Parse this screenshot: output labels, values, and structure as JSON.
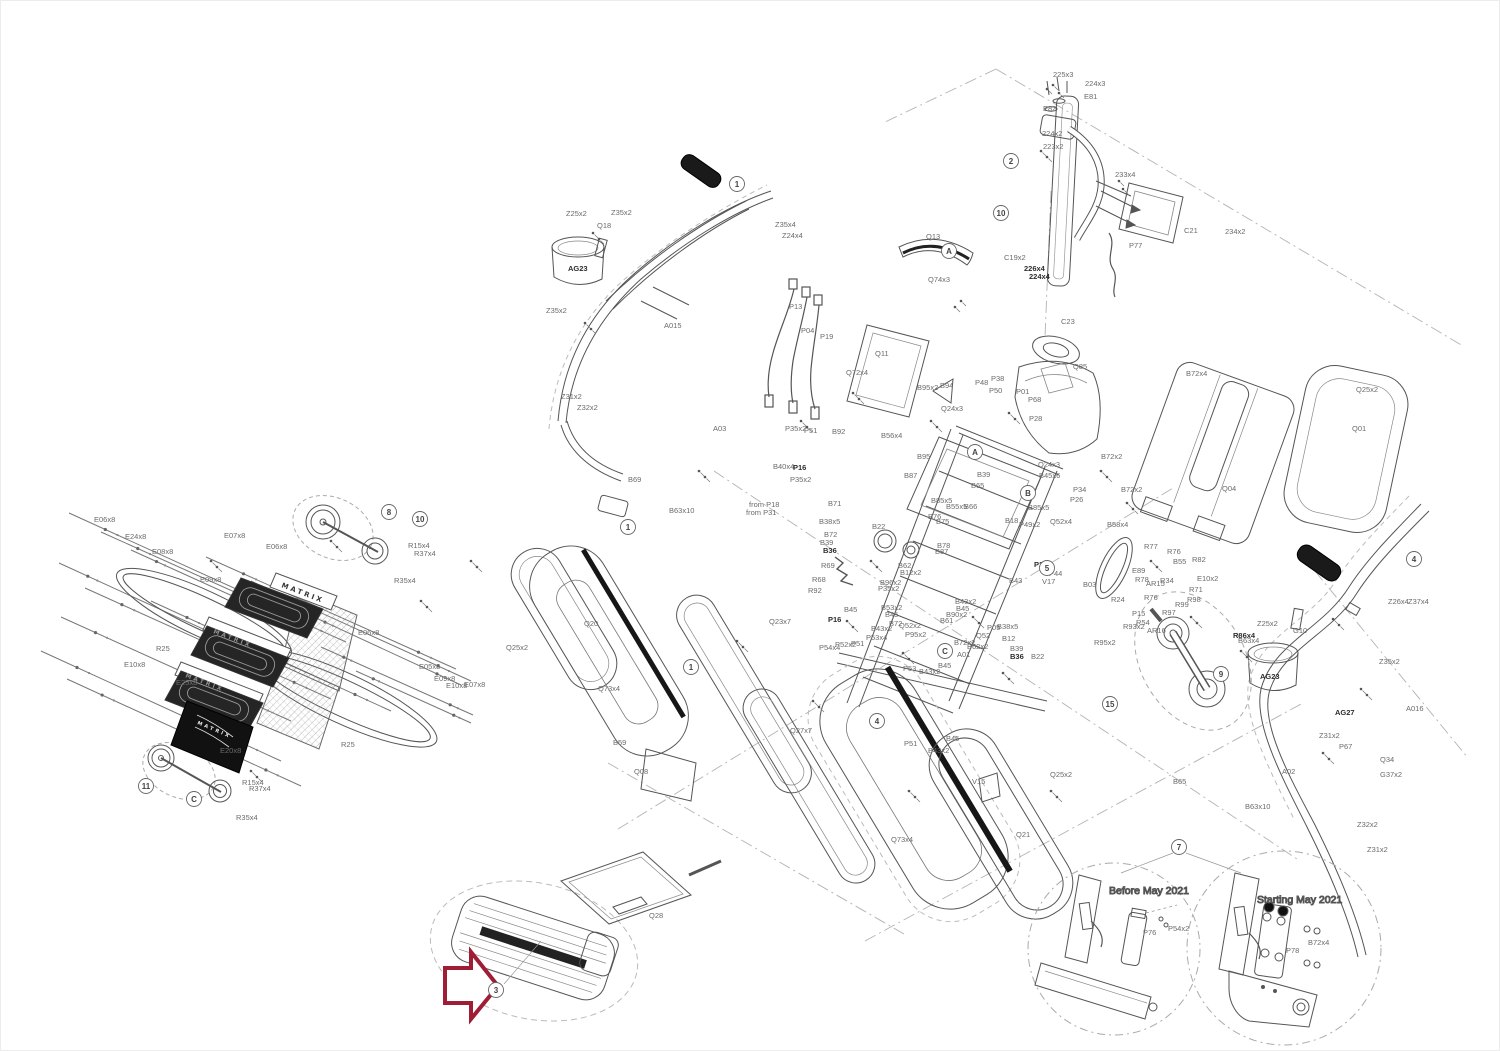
{
  "meta": {
    "brand": "MATRIX",
    "diagram_type": "exploded parts diagram"
  },
  "colors": {
    "line": "#555555",
    "label": "#6b6b6b",
    "arrow": "#a01e35",
    "dash": "#b3b3b3",
    "dark_part": "#1c1c1c"
  },
  "detail_views": [
    {
      "title": "Before May 2021",
      "parts": [
        "P76",
        "P54x2"
      ]
    },
    {
      "title": "Starting May 2021",
      "parts": [
        "P78",
        "B72x4"
      ]
    }
  ],
  "arrow": {
    "balloon": "3"
  },
  "balloons": [
    {
      "n": "1",
      "x": 736,
      "y": 183
    },
    {
      "n": "2",
      "x": 1010,
      "y": 160
    },
    {
      "n": "10",
      "x": 1000,
      "y": 212
    },
    {
      "n": "A",
      "x": 948,
      "y": 250
    },
    {
      "n": "A",
      "x": 974,
      "y": 451
    },
    {
      "n": "B",
      "x": 1027,
      "y": 492
    },
    {
      "n": "5",
      "x": 1046,
      "y": 567
    },
    {
      "n": "C",
      "x": 944,
      "y": 650
    },
    {
      "n": "1",
      "x": 690,
      "y": 666
    },
    {
      "n": "1",
      "x": 627,
      "y": 526
    },
    {
      "n": "4",
      "x": 876,
      "y": 720
    },
    {
      "n": "4",
      "x": 1413,
      "y": 558
    },
    {
      "n": "9",
      "x": 1220,
      "y": 673
    },
    {
      "n": "15",
      "x": 1109,
      "y": 703
    },
    {
      "n": "8",
      "x": 388,
      "y": 511
    },
    {
      "n": "10",
      "x": 419,
      "y": 518
    },
    {
      "n": "11",
      "x": 145,
      "y": 785
    },
    {
      "n": "C",
      "x": 193,
      "y": 798
    },
    {
      "n": "7",
      "x": 1178,
      "y": 846
    },
    {
      "n": "3",
      "x": 495,
      "y": 989
    }
  ],
  "brand_marks": [
    {
      "text": "MATRIX",
      "x": 280,
      "y": 586,
      "rot": 21,
      "fill": "#3a3a3a",
      "size": 7
    },
    {
      "text": "MATRIX",
      "x": 212,
      "y": 632,
      "rot": 21,
      "fill": "#8f8f8f",
      "size": 6
    },
    {
      "text": "MATRIX",
      "x": 184,
      "y": 676,
      "rot": 21,
      "fill": "#8f8f8f",
      "size": 6
    },
    {
      "text": "MATRIX",
      "x": 196,
      "y": 723,
      "rot": 23,
      "fill": "#e8e8e8",
      "size": 5
    }
  ],
  "labels": [
    {
      "t": "225x3",
      "x": 1052,
      "y": 76
    },
    {
      "t": "224x3",
      "x": 1084,
      "y": 85
    },
    {
      "t": "E81",
      "x": 1083,
      "y": 98
    },
    {
      "t": "E82",
      "x": 1042,
      "y": 110
    },
    {
      "t": "224x2",
      "x": 1041,
      "y": 135
    },
    {
      "t": "223x2",
      "x": 1042,
      "y": 148
    },
    {
      "t": "233x4",
      "x": 1114,
      "y": 176
    },
    {
      "t": "C21",
      "x": 1183,
      "y": 232
    },
    {
      "t": "234x2",
      "x": 1224,
      "y": 233
    },
    {
      "t": "P77",
      "x": 1128,
      "y": 247
    },
    {
      "t": "C19x2",
      "x": 1003,
      "y": 259
    },
    {
      "t": "226x4",
      "x": 1023,
      "y": 270,
      "b": 1
    },
    {
      "t": "224x4",
      "x": 1028,
      "y": 278,
      "b": 1
    },
    {
      "t": "Q13",
      "x": 925,
      "y": 238
    },
    {
      "t": "Q74x3",
      "x": 927,
      "y": 281
    },
    {
      "t": "C23",
      "x": 1060,
      "y": 323
    },
    {
      "t": "Q85",
      "x": 1072,
      "y": 368
    },
    {
      "t": "P13",
      "x": 788,
      "y": 308
    },
    {
      "t": "P04",
      "x": 800,
      "y": 332
    },
    {
      "t": "P19",
      "x": 819,
      "y": 338
    },
    {
      "t": "Q11",
      "x": 874,
      "y": 355
    },
    {
      "t": "Q72x4",
      "x": 845,
      "y": 374
    },
    {
      "t": "B95x2",
      "x": 916,
      "y": 389
    },
    {
      "t": "B94",
      "x": 939,
      "y": 387
    },
    {
      "t": "Q24x3",
      "x": 940,
      "y": 410
    },
    {
      "t": "P48",
      "x": 974,
      "y": 384
    },
    {
      "t": "P38",
      "x": 990,
      "y": 380
    },
    {
      "t": "P50",
      "x": 988,
      "y": 392
    },
    {
      "t": "P01",
      "x": 1015,
      "y": 393
    },
    {
      "t": "P68",
      "x": 1027,
      "y": 401
    },
    {
      "t": "P28",
      "x": 1028,
      "y": 420
    },
    {
      "t": "B72x2",
      "x": 1100,
      "y": 458
    },
    {
      "t": "B72x2",
      "x": 1120,
      "y": 491
    },
    {
      "t": "P34",
      "x": 1072,
      "y": 491
    },
    {
      "t": "P26",
      "x": 1069,
      "y": 501
    },
    {
      "t": "B58x4",
      "x": 1106,
      "y": 526
    },
    {
      "t": "Q52x4",
      "x": 1049,
      "y": 523
    },
    {
      "t": "B45x6",
      "x": 1038,
      "y": 477
    },
    {
      "t": "Q24x3",
      "x": 1037,
      "y": 466
    },
    {
      "t": "P49x2",
      "x": 1018,
      "y": 526
    },
    {
      "t": "B18",
      "x": 1004,
      "y": 522
    },
    {
      "t": "B85x5",
      "x": 1027,
      "y": 509
    },
    {
      "t": "B55x5",
      "x": 945,
      "y": 508
    },
    {
      "t": "B66",
      "x": 963,
      "y": 508
    },
    {
      "t": "B85x5",
      "x": 930,
      "y": 502
    },
    {
      "t": "B76",
      "x": 927,
      "y": 518
    },
    {
      "t": "B75",
      "x": 935,
      "y": 523
    },
    {
      "t": "B78",
      "x": 936,
      "y": 547
    },
    {
      "t": "B87",
      "x": 934,
      "y": 553
    },
    {
      "t": "B39",
      "x": 976,
      "y": 476
    },
    {
      "t": "B65",
      "x": 970,
      "y": 487
    },
    {
      "t": "B56x4",
      "x": 880,
      "y": 437
    },
    {
      "t": "B95",
      "x": 916,
      "y": 458
    },
    {
      "t": "B87",
      "x": 903,
      "y": 477
    },
    {
      "t": "B71",
      "x": 827,
      "y": 505
    },
    {
      "t": "B38x5",
      "x": 818,
      "y": 523
    },
    {
      "t": "B72",
      "x": 823,
      "y": 536
    },
    {
      "t": "B39",
      "x": 819,
      "y": 544
    },
    {
      "t": "B36",
      "x": 822,
      "y": 552,
      "b": 1
    },
    {
      "t": "R69",
      "x": 820,
      "y": 567
    },
    {
      "t": "R68",
      "x": 811,
      "y": 581
    },
    {
      "t": "R92",
      "x": 807,
      "y": 592
    },
    {
      "t": "B22",
      "x": 871,
      "y": 528
    },
    {
      "t": "P51",
      "x": 803,
      "y": 432
    },
    {
      "t": "B92",
      "x": 831,
      "y": 433
    },
    {
      "t": "P35x2",
      "x": 784,
      "y": 430
    },
    {
      "t": "B40x4",
      "x": 772,
      "y": 468
    },
    {
      "t": "P16",
      "x": 792,
      "y": 469,
      "b": 1
    },
    {
      "t": "P35x2",
      "x": 789,
      "y": 481
    },
    {
      "t": "B62",
      "x": 897,
      "y": 567
    },
    {
      "t": "B12x2",
      "x": 899,
      "y": 574
    },
    {
      "t": "B96x2",
      "x": 879,
      "y": 584
    },
    {
      "t": "P35x2",
      "x": 877,
      "y": 590
    },
    {
      "t": "B45",
      "x": 843,
      "y": 611
    },
    {
      "t": "P16",
      "x": 827,
      "y": 621,
      "b": 1
    },
    {
      "t": "B53x2",
      "x": 880,
      "y": 609
    },
    {
      "t": "B45",
      "x": 884,
      "y": 616
    },
    {
      "t": "B43x2",
      "x": 870,
      "y": 630
    },
    {
      "t": "B72",
      "x": 888,
      "y": 625
    },
    {
      "t": "Q52x2",
      "x": 898,
      "y": 627
    },
    {
      "t": "P95x2",
      "x": 904,
      "y": 636
    },
    {
      "t": "P53x4",
      "x": 865,
      "y": 639
    },
    {
      "t": "P52x2",
      "x": 834,
      "y": 646
    },
    {
      "t": "P51",
      "x": 850,
      "y": 645
    },
    {
      "t": "P54x4",
      "x": 818,
      "y": 649
    },
    {
      "t": "B90x2",
      "x": 945,
      "y": 616
    },
    {
      "t": "B61",
      "x": 939,
      "y": 622
    },
    {
      "t": "B43x2",
      "x": 954,
      "y": 603
    },
    {
      "t": "B45",
      "x": 955,
      "y": 610
    },
    {
      "t": "P05",
      "x": 986,
      "y": 629
    },
    {
      "t": "B38x5",
      "x": 996,
      "y": 628
    },
    {
      "t": "B12",
      "x": 1001,
      "y": 640
    },
    {
      "t": "B39",
      "x": 1009,
      "y": 650
    },
    {
      "t": "B36",
      "x": 1009,
      "y": 658,
      "b": 1
    },
    {
      "t": "B22",
      "x": 1030,
      "y": 658
    },
    {
      "t": "B72x2",
      "x": 953,
      "y": 644
    },
    {
      "t": "Q52",
      "x": 975,
      "y": 637
    },
    {
      "t": "B62x2",
      "x": 966,
      "y": 648
    },
    {
      "t": "A01",
      "x": 956,
      "y": 656
    },
    {
      "t": "P53",
      "x": 902,
      "y": 670
    },
    {
      "t": "B43x2",
      "x": 918,
      "y": 673
    },
    {
      "t": "B45",
      "x": 937,
      "y": 667
    },
    {
      "t": "P51",
      "x": 903,
      "y": 745
    },
    {
      "t": "B43x2",
      "x": 927,
      "y": 752
    },
    {
      "t": "B45",
      "x": 945,
      "y": 740
    },
    {
      "t": "P23",
      "x": 1033,
      "y": 566,
      "b": 1
    },
    {
      "t": "P44",
      "x": 1048,
      "y": 575
    },
    {
      "t": "B43",
      "x": 1008,
      "y": 582
    },
    {
      "t": "V17",
      "x": 1041,
      "y": 583
    },
    {
      "t": "B63x10",
      "x": 668,
      "y": 512
    },
    {
      "t": "B69",
      "x": 627,
      "y": 481
    },
    {
      "t": "A03",
      "x": 712,
      "y": 430
    },
    {
      "t": "from P18",
      "x": 748,
      "y": 506
    },
    {
      "t": "from P31",
      "x": 745,
      "y": 514
    },
    {
      "t": "Q25x2",
      "x": 505,
      "y": 649
    },
    {
      "t": "Q20",
      "x": 583,
      "y": 625
    },
    {
      "t": "Q73x4",
      "x": 597,
      "y": 690
    },
    {
      "t": "B59",
      "x": 612,
      "y": 744
    },
    {
      "t": "Q08",
      "x": 633,
      "y": 773
    },
    {
      "t": "Q23x7",
      "x": 768,
      "y": 623
    },
    {
      "t": "Q27x7",
      "x": 789,
      "y": 732
    },
    {
      "t": "Q73x4",
      "x": 890,
      "y": 841
    },
    {
      "t": "V15",
      "x": 971,
      "y": 783
    },
    {
      "t": "Q21",
      "x": 1015,
      "y": 836
    },
    {
      "t": "Q25x2",
      "x": 1049,
      "y": 776
    },
    {
      "t": "Q28",
      "x": 648,
      "y": 917
    },
    {
      "t": "E06x8",
      "x": 93,
      "y": 521
    },
    {
      "t": "E24x8",
      "x": 124,
      "y": 538
    },
    {
      "t": "E08x8",
      "x": 151,
      "y": 553
    },
    {
      "t": "E07x8",
      "x": 223,
      "y": 537
    },
    {
      "t": "E06x8",
      "x": 265,
      "y": 548
    },
    {
      "t": "E09x8",
      "x": 199,
      "y": 581
    },
    {
      "t": "R25",
      "x": 155,
      "y": 650
    },
    {
      "t": "E10x8",
      "x": 123,
      "y": 666
    },
    {
      "t": "E25x8",
      "x": 175,
      "y": 684
    },
    {
      "t": "E20x8",
      "x": 219,
      "y": 752
    },
    {
      "t": "E06x8",
      "x": 357,
      "y": 634
    },
    {
      "t": "E05x8",
      "x": 418,
      "y": 668
    },
    {
      "t": "E09x8",
      "x": 433,
      "y": 680
    },
    {
      "t": "E10x8",
      "x": 445,
      "y": 687
    },
    {
      "t": "E07x8",
      "x": 463,
      "y": 686
    },
    {
      "t": "R25",
      "x": 340,
      "y": 746
    },
    {
      "t": "R15x4",
      "x": 407,
      "y": 547
    },
    {
      "t": "R37x4",
      "x": 413,
      "y": 555
    },
    {
      "t": "R35x4",
      "x": 393,
      "y": 582
    },
    {
      "t": "R15x4",
      "x": 241,
      "y": 784
    },
    {
      "t": "R37x4",
      "x": 248,
      "y": 790
    },
    {
      "t": "R35x4",
      "x": 235,
      "y": 819
    },
    {
      "t": "R77",
      "x": 1143,
      "y": 548
    },
    {
      "t": "R76",
      "x": 1166,
      "y": 553
    },
    {
      "t": "B55",
      "x": 1172,
      "y": 563
    },
    {
      "t": "R82",
      "x": 1191,
      "y": 561
    },
    {
      "t": "E89",
      "x": 1131,
      "y": 572
    },
    {
      "t": "E10x2",
      "x": 1196,
      "y": 580
    },
    {
      "t": "R78",
      "x": 1134,
      "y": 581
    },
    {
      "t": "AR15",
      "x": 1145,
      "y": 585
    },
    {
      "t": "R34",
      "x": 1159,
      "y": 582
    },
    {
      "t": "R71",
      "x": 1188,
      "y": 591
    },
    {
      "t": "R76",
      "x": 1143,
      "y": 599
    },
    {
      "t": "R98",
      "x": 1186,
      "y": 601
    },
    {
      "t": "R99",
      "x": 1174,
      "y": 606
    },
    {
      "t": "P15",
      "x": 1131,
      "y": 615
    },
    {
      "t": "R97",
      "x": 1161,
      "y": 614
    },
    {
      "t": "R54",
      "x": 1135,
      "y": 624
    },
    {
      "t": "AR16",
      "x": 1146,
      "y": 632
    },
    {
      "t": "R93x2",
      "x": 1122,
      "y": 628
    },
    {
      "t": "R95x2",
      "x": 1093,
      "y": 644
    },
    {
      "t": "R24",
      "x": 1110,
      "y": 601
    },
    {
      "t": "B03",
      "x": 1082,
      "y": 586
    },
    {
      "t": "R86x4",
      "x": 1232,
      "y": 637,
      "b": 1
    },
    {
      "t": "B63x4",
      "x": 1237,
      "y": 642
    },
    {
      "t": "B72x4",
      "x": 1185,
      "y": 375
    },
    {
      "t": "Q25x2",
      "x": 1355,
      "y": 391
    },
    {
      "t": "Q01",
      "x": 1351,
      "y": 430
    },
    {
      "t": "Q04",
      "x": 1221,
      "y": 490
    },
    {
      "t": "Z26x4",
      "x": 1387,
      "y": 603
    },
    {
      "t": "Z37x4",
      "x": 1407,
      "y": 603
    },
    {
      "t": "Z25x2",
      "x": 1256,
      "y": 625
    },
    {
      "t": "G10",
      "x": 1292,
      "y": 632
    },
    {
      "t": "AG23",
      "x": 1259,
      "y": 678,
      "b": 1
    },
    {
      "t": "Z35x2",
      "x": 1378,
      "y": 663
    },
    {
      "t": "AG27",
      "x": 1334,
      "y": 714,
      "b": 1
    },
    {
      "t": "P67",
      "x": 1338,
      "y": 748
    },
    {
      "t": "Q34",
      "x": 1379,
      "y": 761
    },
    {
      "t": "G37x2",
      "x": 1379,
      "y": 776
    },
    {
      "t": "A016",
      "x": 1405,
      "y": 710
    },
    {
      "t": "A02",
      "x": 1281,
      "y": 773
    },
    {
      "t": "B65",
      "x": 1172,
      "y": 783
    },
    {
      "t": "B63x10",
      "x": 1244,
      "y": 808
    },
    {
      "t": "Z31x2",
      "x": 1318,
      "y": 737
    },
    {
      "t": "Z32x2",
      "x": 1356,
      "y": 826
    },
    {
      "t": "Z31x2",
      "x": 1366,
      "y": 851
    },
    {
      "t": "Z25x2",
      "x": 565,
      "y": 215
    },
    {
      "t": "Z35x2",
      "x": 610,
      "y": 214
    },
    {
      "t": "Q18",
      "x": 596,
      "y": 227
    },
    {
      "t": "AG23",
      "x": 567,
      "y": 270,
      "b": 1
    },
    {
      "t": "Z35x2",
      "x": 545,
      "y": 312
    },
    {
      "t": "A015",
      "x": 663,
      "y": 327
    },
    {
      "t": "Z31x2",
      "x": 560,
      "y": 398
    },
    {
      "t": "Z32x2",
      "x": 576,
      "y": 409
    },
    {
      "t": "Z35x4",
      "x": 774,
      "y": 226
    },
    {
      "t": "Z24x4",
      "x": 781,
      "y": 237
    },
    {
      "t": "P76",
      "x": 1142,
      "y": 934
    },
    {
      "t": "P54x2",
      "x": 1167,
      "y": 930
    },
    {
      "t": "P78",
      "x": 1285,
      "y": 952
    },
    {
      "t": "B72x4",
      "x": 1307,
      "y": 944
    }
  ]
}
